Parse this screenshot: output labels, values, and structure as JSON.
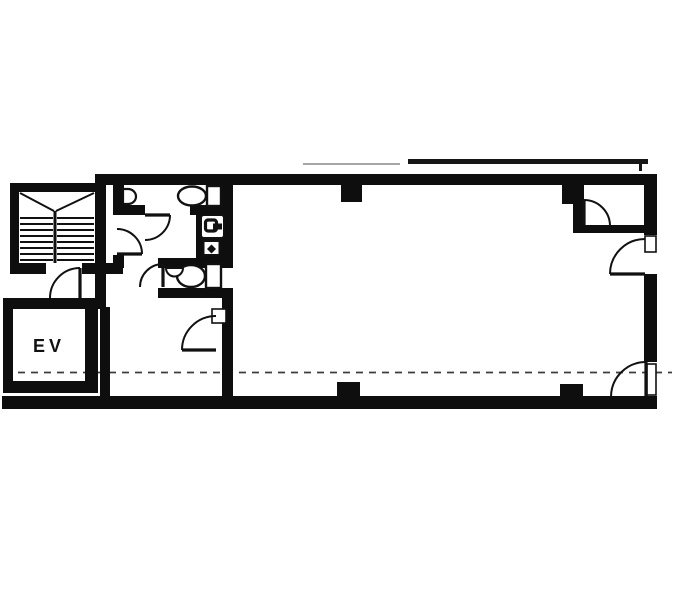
{
  "meta": {
    "title": "Scanned building floor plan",
    "type": "architectural-floor-plan"
  },
  "labels": {
    "elevator": "EV"
  },
  "colors": {
    "paper": "#ffffff",
    "wall": "#0e0e0e",
    "line": "#111111",
    "eave_light": "#a6a6a6",
    "eave_dark": "#161616",
    "centerline": "#3d3d3d"
  },
  "plan": {
    "canvas": {
      "w": 681,
      "h": 597
    },
    "centerline": {
      "x1": 5,
      "y": 372.5,
      "x2": 672,
      "width": 1.8,
      "dash": "7 6"
    },
    "rooms": [
      {
        "name": "stairwell",
        "x": 19,
        "y": 192,
        "w": 76,
        "h": 71
      },
      {
        "name": "elevator-room",
        "x": 13,
        "y": 309,
        "w": 72,
        "h": 72
      },
      {
        "name": "upper-toilet-room",
        "x": 124,
        "y": 185,
        "w": 96,
        "h": 20
      },
      {
        "name": "toilet-lobby",
        "x": 124,
        "y": 215,
        "w": 72,
        "h": 43
      },
      {
        "name": "lower-toilet-room",
        "x": 166,
        "y": 268,
        "w": 56,
        "h": 20
      },
      {
        "name": "hall",
        "x": 110,
        "y": 298,
        "w": 112,
        "h": 98
      },
      {
        "name": "main-room",
        "x": 233,
        "y": 185,
        "w": 411,
        "h": 211
      },
      {
        "name": "closet",
        "x": 583,
        "y": 185,
        "w": 61,
        "h": 40
      }
    ],
    "walls": [
      {
        "name": "top-wall",
        "x": 95,
        "y": 174,
        "w": 562,
        "h": 11
      },
      {
        "name": "stair-top-wall",
        "x": 10,
        "y": 183,
        "w": 93,
        "h": 9
      },
      {
        "name": "stair-left-wall",
        "x": 10,
        "y": 183,
        "w": 9,
        "h": 89
      },
      {
        "name": "stair-right-wall",
        "x": 95,
        "y": 185,
        "w": 11,
        "h": 124
      },
      {
        "name": "stair-bottom-wall-left",
        "x": 10,
        "y": 263,
        "w": 36,
        "h": 11
      },
      {
        "name": "stair-bottom-wall-right",
        "x": 82,
        "y": 263,
        "w": 41,
        "h": 11
      },
      {
        "name": "ev-top-wall",
        "x": 3,
        "y": 298,
        "w": 95,
        "h": 11
      },
      {
        "name": "ev-left-wall",
        "x": 3,
        "y": 298,
        "w": 10,
        "h": 95
      },
      {
        "name": "ev-bottom-wall",
        "x": 3,
        "y": 381,
        "w": 95,
        "h": 12
      },
      {
        "name": "ev-right-wall",
        "x": 85,
        "y": 298,
        "w": 13,
        "h": 95
      },
      {
        "name": "main-left-wall",
        "x": 100,
        "y": 307,
        "w": 10,
        "h": 90
      },
      {
        "name": "bottom-wall",
        "x": 2,
        "y": 396,
        "w": 655,
        "h": 13
      },
      {
        "name": "right-wall-upper",
        "x": 644,
        "y": 174,
        "w": 13,
        "h": 61
      },
      {
        "name": "right-wall-middle",
        "x": 644,
        "y": 274,
        "w": 13,
        "h": 88
      },
      {
        "name": "right-wall-corner",
        "x": 644,
        "y": 397,
        "w": 13,
        "h": 12
      },
      {
        "name": "toilet-left-wall",
        "x": 113,
        "y": 185,
        "w": 11,
        "h": 28
      },
      {
        "name": "toilet-left-stub",
        "x": 113,
        "y": 255,
        "w": 11,
        "h": 13
      },
      {
        "name": "toilet-mid-wall-left",
        "x": 113,
        "y": 205,
        "w": 32,
        "h": 10
      },
      {
        "name": "toilet-mid-wall-right",
        "x": 190,
        "y": 205,
        "w": 43,
        "h": 10
      },
      {
        "name": "toilet-right-wall",
        "x": 220,
        "y": 185,
        "w": 13,
        "h": 30
      },
      {
        "name": "sink-wall-block",
        "x": 196,
        "y": 211,
        "w": 37,
        "h": 48
      },
      {
        "name": "lower-toilet-top-wall",
        "x": 158,
        "y": 258,
        "w": 75,
        "h": 10
      },
      {
        "name": "lower-toilet-bottom-wall",
        "x": 158,
        "y": 288,
        "w": 75,
        "h": 10
      },
      {
        "name": "partition-wall",
        "x": 222,
        "y": 288,
        "w": 11,
        "h": 114
      },
      {
        "name": "closet-left-wall",
        "x": 573,
        "y": 185,
        "w": 10,
        "h": 48
      },
      {
        "name": "closet-bottom-wall",
        "x": 573,
        "y": 225,
        "w": 84,
        "h": 8
      },
      {
        "name": "column-top-1",
        "x": 341,
        "y": 185,
        "w": 21,
        "h": 17
      },
      {
        "name": "column-top-2",
        "x": 562,
        "y": 185,
        "w": 22,
        "h": 19
      },
      {
        "name": "column-bottom-1",
        "x": 337,
        "y": 382,
        "w": 23,
        "h": 16
      },
      {
        "name": "column-bottom-2",
        "x": 560,
        "y": 384,
        "w": 23,
        "h": 14
      }
    ],
    "eave_lines": [
      {
        "name": "eave-line-left",
        "x": 303,
        "y": 163,
        "w": 97,
        "h": 2,
        "color_key": "eave_light"
      },
      {
        "name": "eave-line-right",
        "x": 408,
        "y": 159,
        "w": 240,
        "h": 5,
        "color_key": "eave_dark"
      },
      {
        "name": "eave-line-tick",
        "x": 639,
        "y": 159,
        "w": 3,
        "h": 12,
        "color_key": "eave_dark"
      }
    ],
    "jambs": [
      {
        "name": "hall-door-jamb",
        "x": 212,
        "y": 309,
        "w": 14,
        "h": 14
      },
      {
        "name": "entry-upper-door-jamb",
        "x": 645,
        "y": 236,
        "w": 11,
        "h": 16
      },
      {
        "name": "entry-lower-door-jamb",
        "x": 647,
        "y": 364,
        "w": 9,
        "h": 31
      }
    ],
    "doors": [
      {
        "name": "stair-door",
        "leaf": [
          80,
          268,
          80,
          298
        ],
        "arc": "M80,268 A30,30 0 0 0 50,298"
      },
      {
        "name": "lobby-door",
        "leaf": [
          117,
          254,
          142,
          254
        ],
        "arc": "M142,254 A25,25 0 0 0 117,229"
      },
      {
        "name": "upper-toilet-door",
        "leaf": [
          145,
          215,
          170,
          215
        ],
        "arc": "M170,215 A25,25 0 0 1 145,240"
      },
      {
        "name": "lower-toilet-door",
        "leaf": [
          163,
          264,
          163,
          287
        ],
        "arc": "M163,264 A23,23 0 0 0 140,287"
      },
      {
        "name": "hall-door",
        "leaf": [
          182,
          350,
          216,
          350
        ],
        "arc": "M216,316 A34,34 0 0 0 182,350"
      },
      {
        "name": "closet-door",
        "leaf": [
          584,
          200,
          584,
          226
        ],
        "arc": "M584,200 A26,26 0 0 1 610,226"
      },
      {
        "name": "entry-door-upper",
        "leaf": [
          610,
          274,
          645,
          274
        ],
        "arc": "M645,239 A35,35 0 0 0 610,274"
      },
      {
        "name": "entry-door-lower",
        "leaf": [
          646,
          362,
          646,
          397
        ],
        "arc": "M646,362 A35,35 0 0 0 611,397"
      }
    ],
    "stairs": {
      "diagonals": [
        [
          20,
          193,
          54,
          211
        ],
        [
          94,
          193,
          56,
          211
        ]
      ],
      "divider": [
        55,
        211,
        55,
        263
      ],
      "treads_y": [
        218,
        224,
        230,
        236,
        242,
        248,
        254,
        260
      ],
      "left_flight_x": [
        20,
        53
      ],
      "right_flight_x": [
        57,
        94
      ]
    },
    "fixtures": {
      "upper_toilet": {
        "tank": {
          "x": 207,
          "y": 186,
          "w": 14,
          "h": 20
        },
        "bowl": {
          "cx": 192,
          "cy": 196,
          "rx": 14,
          "ry": 9.5
        }
      },
      "lower_toilet": {
        "tank": {
          "x": 206,
          "y": 264,
          "w": 15,
          "h": 24
        },
        "bowl": {
          "cx": 191,
          "cy": 276,
          "rx": 14,
          "ry": 11
        }
      },
      "urinal": {
        "path": "M123,189 L128,189 A8,7.5 0 0 1 128,204 L123,204 Z"
      },
      "cistern_bump": {
        "path": "M166,268 A8.5,8.5 0 0 0 183,268 Z"
      },
      "sink_unit": {
        "basin_box": {
          "x": 201,
          "y": 215,
          "w": 23,
          "h": 23,
          "r": 3
        },
        "tap_outline": {
          "x": 205.5,
          "y": 220,
          "w": 11,
          "h": 11,
          "r": 2.5
        },
        "tap_arm": {
          "x": 213,
          "y": 223.5,
          "w": 9,
          "h": 6
        },
        "lower_box": {
          "x": 203.5,
          "y": 241,
          "w": 16,
          "h": 14
        },
        "drain_diamond": "M211.5,244.5 L216,249 L211.5,253.5 L207,249 Z"
      }
    },
    "ev_text": {
      "x": 49,
      "y": 352,
      "size": 18,
      "letter_spacing": 4
    }
  }
}
